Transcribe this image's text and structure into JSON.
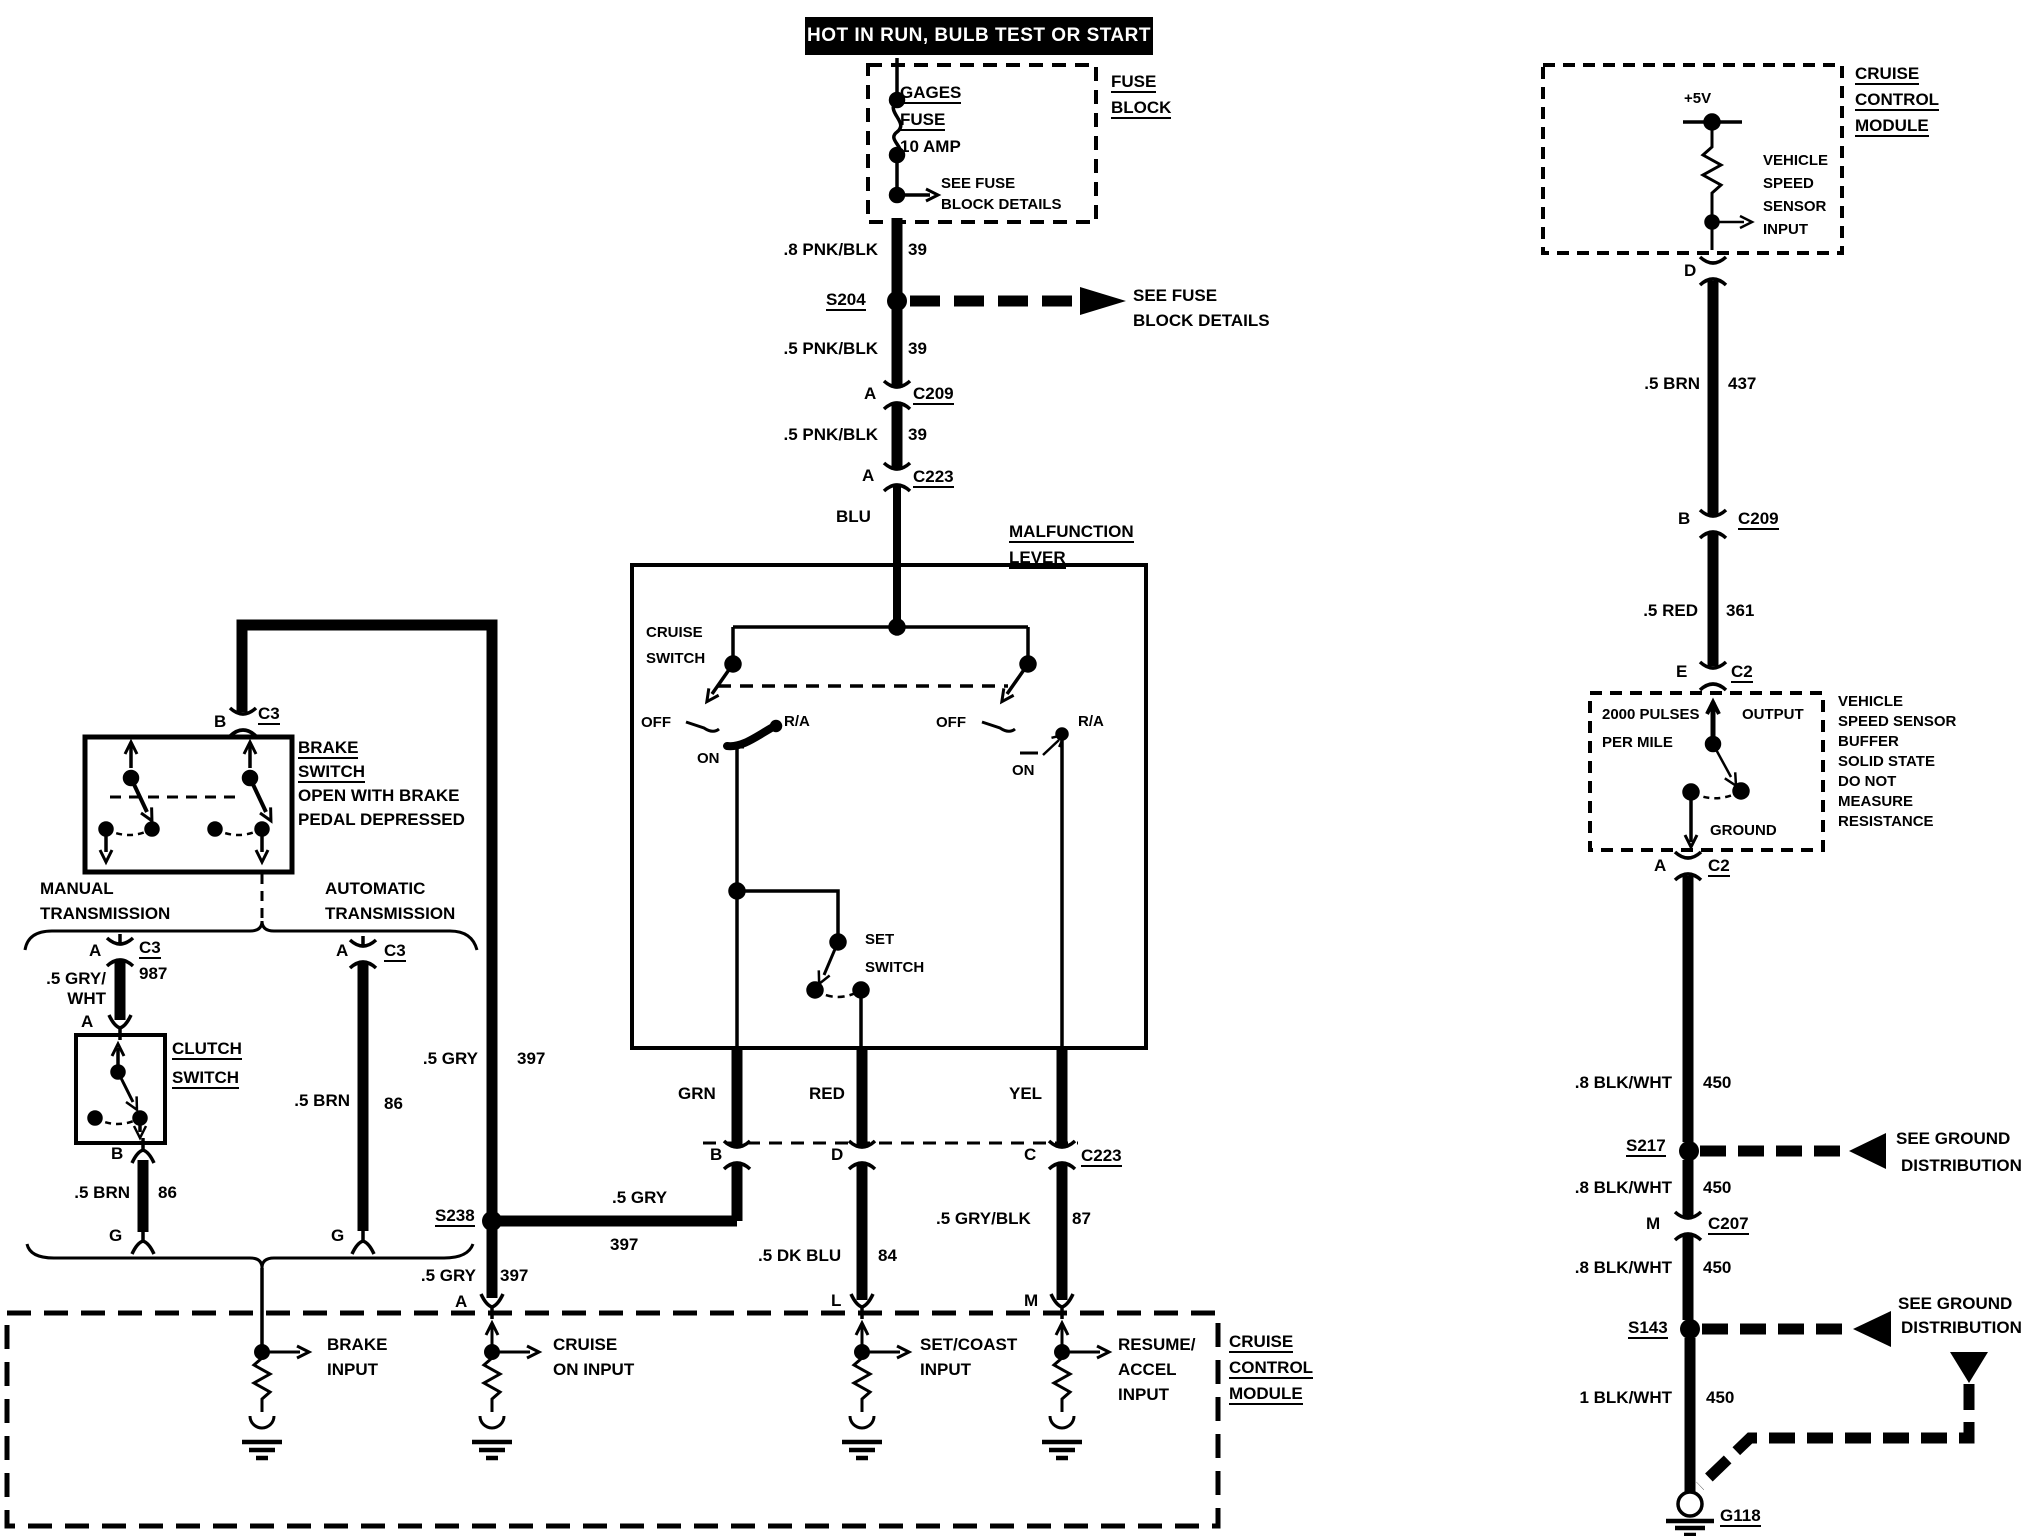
{
  "banner": {
    "text": "HOT IN RUN, BULB TEST OR START"
  },
  "fuse_block": {
    "label_line1": "FUSE",
    "label_line2": "BLOCK",
    "fuse_line1": "GAGES",
    "fuse_line2": "FUSE",
    "rating": "10 AMP",
    "see_line1": "SEE FUSE",
    "see_line2": "BLOCK DETAILS"
  },
  "feed": {
    "wire1": ".8 PNK/BLK",
    "wire1_num": "39",
    "splice": "S204",
    "see_line1": "SEE FUSE",
    "see_line2": "BLOCK DETAILS",
    "wire2": ".5 PNK/BLK",
    "wire2_num": "39",
    "conn1_pin": "A",
    "conn1": "C209",
    "wire3": ".5 PNK/BLK",
    "wire3_num": "39",
    "conn2_pin": "A",
    "conn2": "C223",
    "wire4": "BLU"
  },
  "malfunction_lever": {
    "title_line1": "MALFUNCTION",
    "title_line2": "LEVER",
    "switch_label_line1": "CRUISE",
    "switch_label_line2": "SWITCH",
    "sw1_off": "OFF",
    "sw1_on": "ON",
    "sw1_ra": "R/A",
    "sw2_off": "OFF",
    "sw2_on": "ON",
    "sw2_ra": "R/A",
    "set_line1": "SET",
    "set_line2": "SWITCH",
    "out1": "GRN",
    "out2": "RED",
    "out3": "YEL"
  },
  "junction_row": {
    "pin_b": "B",
    "pin_d": "D",
    "pin_c": "C",
    "conn": "C223",
    "wire_gry": ".5 GRY",
    "wire_gry_num": "397",
    "wire_dkblu": ".5 DK BLU",
    "wire_dkblu_num": "84",
    "wire_gryblk": ".5 GRY/BLK",
    "wire_gryblk_num": "87",
    "splice": "S238",
    "wire_gry2": ".5 GRY",
    "wire_gry2_num": "397",
    "pin_a": "A"
  },
  "module": {
    "pin_l": "L",
    "pin_m": "M",
    "in1_line1": "BRAKE",
    "in1_line2": "INPUT",
    "in2_line1": "CRUISE",
    "in2_line2": "ON INPUT",
    "in3_line1": "SET/COAST",
    "in3_line2": "INPUT",
    "in4_line1": "RESUME/",
    "in4_line2": "ACCEL",
    "in4_line3": "INPUT",
    "name_line1": "CRUISE",
    "name_line2": "CONTROL",
    "name_line3": "MODULE"
  },
  "left": {
    "pin_b": "B",
    "conn_b": "C3",
    "brake_line1": "BRAKE",
    "brake_line2": "SWITCH",
    "brake_line3": "OPEN WITH BRAKE",
    "brake_line4": "PEDAL DEPRESSED",
    "manual_line1": "MANUAL",
    "manual_line2": "TRANSMISSION",
    "auto_line1": "AUTOMATIC",
    "auto_line2": "TRANSMISSION",
    "m_pin": "A",
    "m_conn": "C3",
    "m_circuit": "987",
    "m_wire_line1": ".5 GRY/",
    "m_wire_line2": "WHT",
    "clutch_pin_a": "A",
    "clutch_line1": "CLUTCH",
    "clutch_line2": "SWITCH",
    "clutch_pin_b": "B",
    "m_wire2": ".5 BRN",
    "m_wire2_num": "86",
    "m_pin_g": "G",
    "a_pin": "A",
    "a_conn": "C3",
    "a_wire": ".5 BRN",
    "a_wire_num": "86",
    "a_pin_g": "G",
    "gry_wire": ".5 GRY",
    "gry_num": "397"
  },
  "right": {
    "ccm_line1": "CRUISE",
    "ccm_line2": "CONTROL",
    "ccm_line3": "MODULE",
    "v5": "+5V",
    "vss_line1": "VEHICLE",
    "vss_line2": "SPEED",
    "vss_line3": "SENSOR",
    "vss_line4": "INPUT",
    "pin_d": "D",
    "wire1": ".5 BRN",
    "wire1_num": "437",
    "pin_b": "B",
    "conn1": "C209",
    "wire2": ".5 RED",
    "wire2_num": "361",
    "pin_e": "E",
    "conn2": "C2",
    "buffer_line1": "2000 PULSES",
    "buffer_line2": "PER MILE",
    "buffer_out": "OUTPUT",
    "buffer_gnd": "GROUND",
    "note_line1": "VEHICLE",
    "note_line2": "SPEED SENSOR",
    "note_line3": "BUFFER",
    "note_line4": "SOLID STATE",
    "note_line5": "DO NOT",
    "note_line6": "MEASURE",
    "note_line7": "RESISTANCE",
    "pin_a": "A",
    "conn3": "C2",
    "wire3": ".8 BLK/WHT",
    "wire3_num": "450",
    "splice1": "S217",
    "ref1_line1": "SEE GROUND",
    "ref1_line2": "DISTRIBUTION",
    "wire4": ".8 BLK/WHT",
    "wire4_num": "450",
    "pin_m": "M",
    "conn4": "C207",
    "wire5": ".8 BLK/WHT",
    "wire5_num": "450",
    "splice2": "S143",
    "ref2_line1": "SEE GROUND",
    "ref2_line2": "DISTRIBUTION",
    "wire6": "1 BLK/WHT",
    "wire6_num": "450",
    "ground": "G118"
  }
}
